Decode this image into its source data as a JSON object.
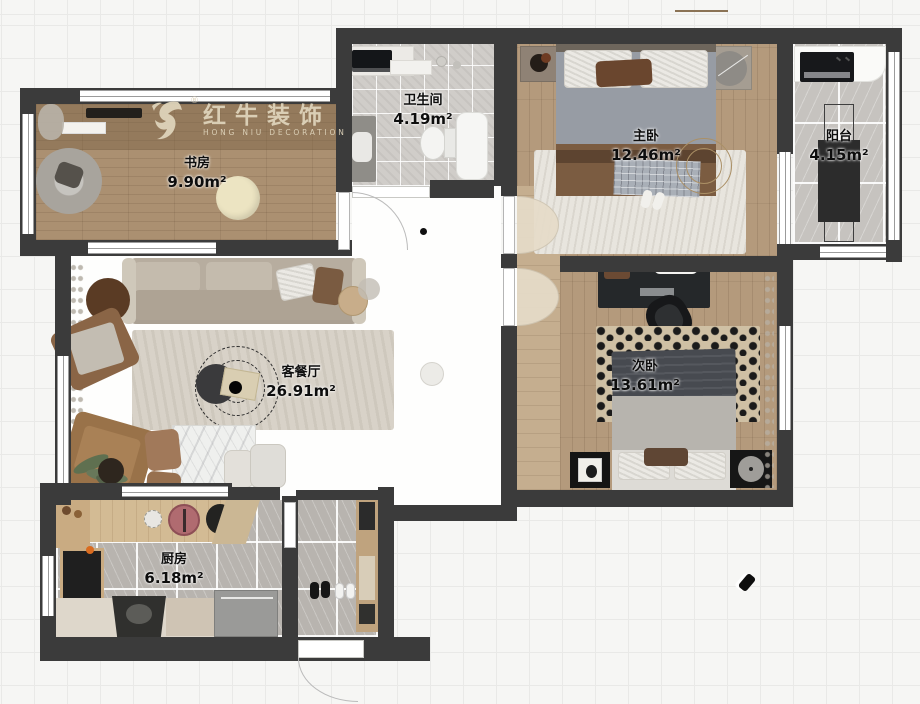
{
  "logo": {
    "brand": "红牛装饰",
    "subtitle": "HONG NIU DECORATION",
    "registered": "®"
  },
  "rooms": [
    {
      "id": "study",
      "name": "书房",
      "area": "9.90m²"
    },
    {
      "id": "bathroom",
      "name": "卫生间",
      "area": "4.19m²"
    },
    {
      "id": "master",
      "name": "主卧",
      "area": "12.46m²"
    },
    {
      "id": "balcony",
      "name": "阳台",
      "area": "4.15m²"
    },
    {
      "id": "living",
      "name": "客餐厅",
      "area": "26.91m²"
    },
    {
      "id": "second",
      "name": "次卧",
      "area": "13.61m²"
    },
    {
      "id": "kitchen",
      "name": "厨房",
      "area": "6.18m²"
    }
  ],
  "colors": {
    "wall": "#3b3b3b",
    "wood": "#b49a7c",
    "bath_tile": "#d0cdc9",
    "gray_tile": "#b8b4af",
    "living_floor": "#fefefd",
    "logo_cream": "#ded3ba",
    "canvas": "#f6f6f4"
  }
}
